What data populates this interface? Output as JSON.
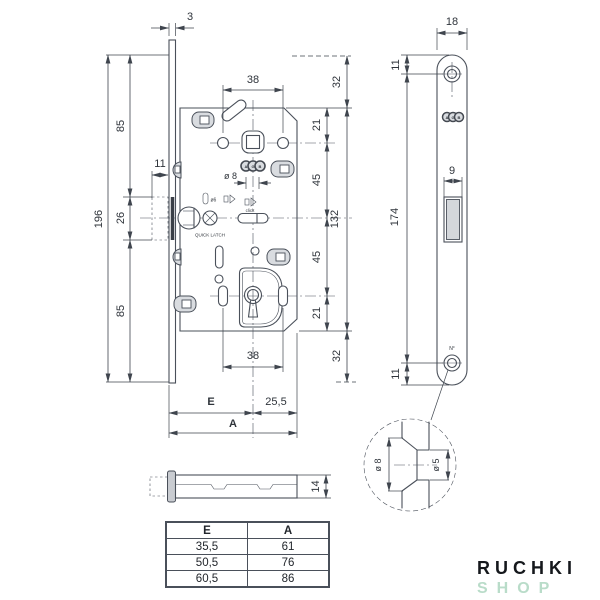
{
  "main_view": {
    "plate_thickness": "3",
    "total_height": "196",
    "seg_top": "85",
    "offset_11": "11",
    "seg_mid": "26",
    "seg_bot": "85",
    "dim38_top": "38",
    "dim32_top": "32",
    "dim21_top": "21",
    "dim45_top": "45",
    "dim132": "132",
    "dim45_bot": "45",
    "dim21_bot": "21",
    "dim38_bot": "38",
    "dim32_bot": "32",
    "hole_dia": "ø 8",
    "latch_dia": "ø6",
    "click_label": "click",
    "quick_latch_label": "QUICK LATCH",
    "backset_label": "E",
    "edge_dist": "25,5",
    "total_width_label": "A"
  },
  "plate_view": {
    "width": "18",
    "screw_top_offset": "11",
    "latch_width": "9",
    "screw_distance": "174",
    "screw_bottom_offset": "11",
    "number_label": "N°",
    "brand": {
      "letters": [
        "A",
        "G",
        "B"
      ]
    }
  },
  "detail_view": {
    "outer_dia": "ø 8",
    "inner_dia": "ø 5"
  },
  "side_view": {
    "body_height": "14"
  },
  "table": {
    "headers": [
      "E",
      "A"
    ],
    "rows": [
      [
        "35,5",
        "61"
      ],
      [
        "50,5",
        "76"
      ],
      [
        "60,5",
        "86"
      ]
    ]
  },
  "logo": {
    "line1": "RUCHKI",
    "line2": "SHOP"
  }
}
